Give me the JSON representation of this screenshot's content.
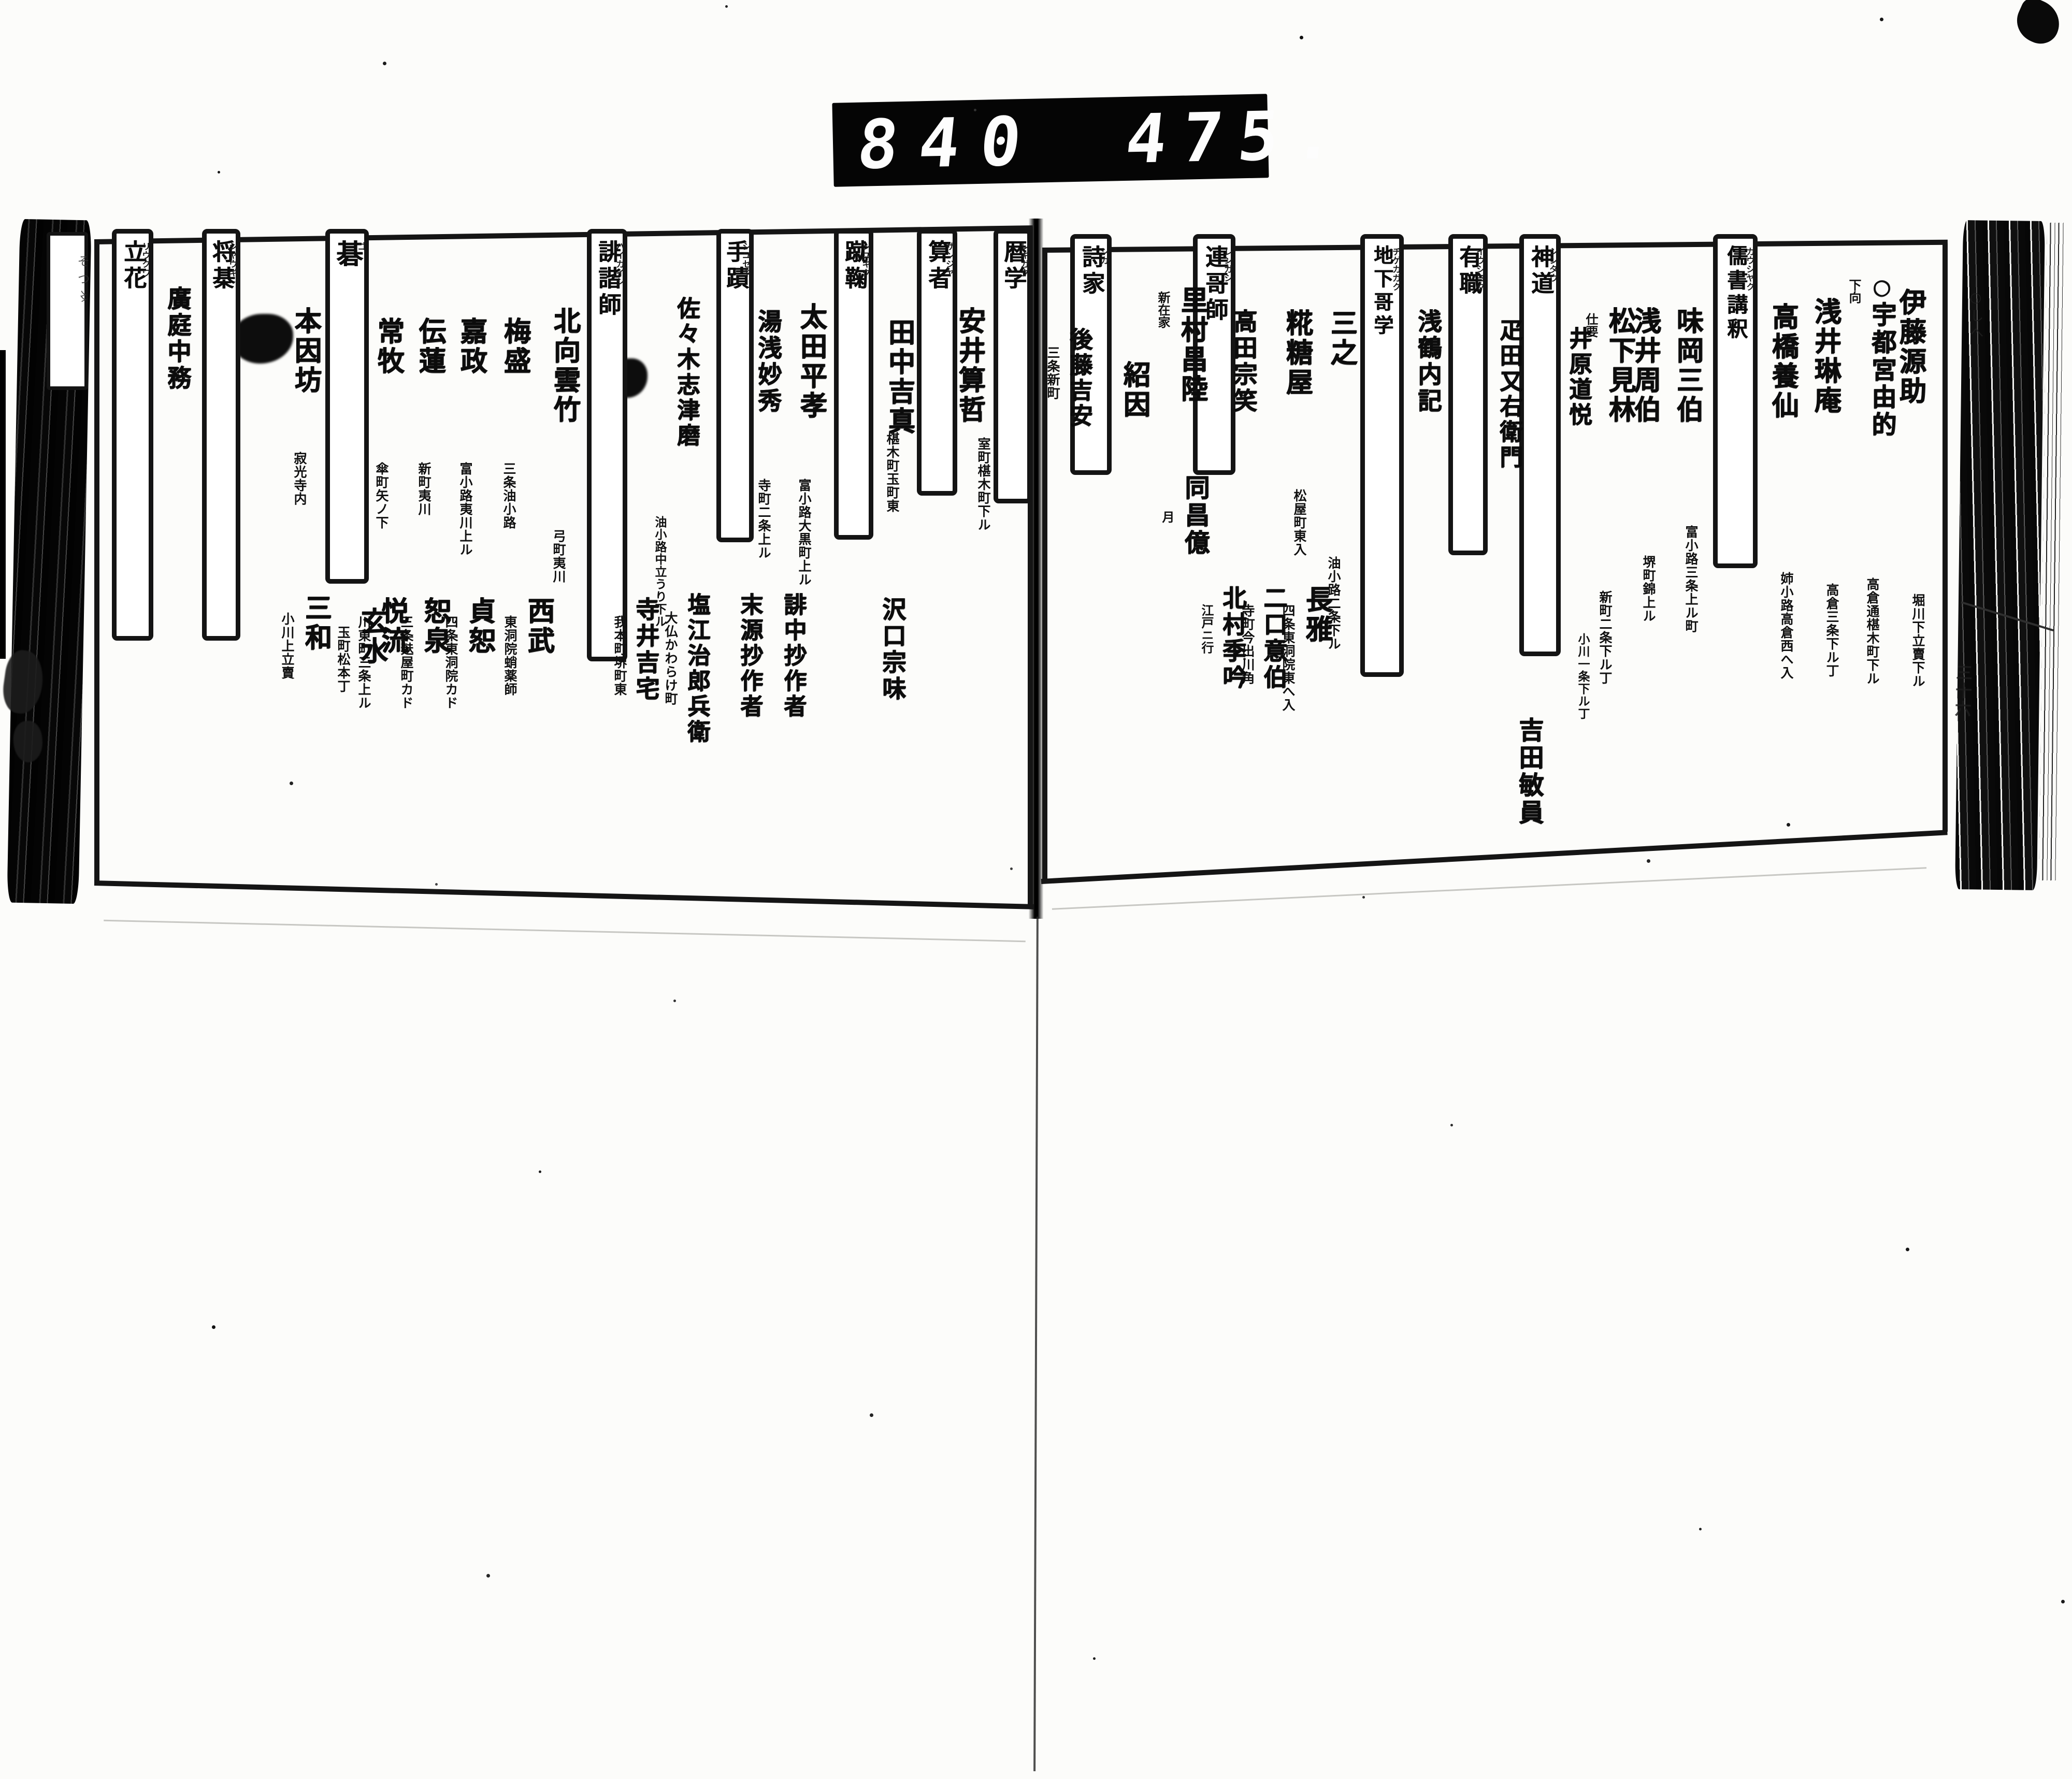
{
  "counter": {
    "left_digits": "840",
    "right_digits": "475."
  },
  "pages": {
    "right": {
      "tabs": [
        {
          "label": "儒書講釈",
          "furigana": "カウシヤク"
        },
        {
          "label": "神道",
          "furigana": "シンタウ"
        },
        {
          "label": "有職",
          "furigana": "イウシヨク"
        },
        {
          "label": "地下哥学",
          "furigana": "ヂゲカガク"
        },
        {
          "label": "連哥師",
          "furigana": "レンガシ"
        },
        {
          "label": "詩家",
          "furigana": "シカ"
        }
      ],
      "entries": [
        {
          "name": "伊藤源助",
          "addr": "堀川下立賣下ル"
        },
        {
          "mark": "○",
          "name": "宇都宮由的",
          "note": "下向",
          "addr": "高倉通椹木町下ル"
        },
        {
          "name": "浅井琳庵",
          "addr": "高倉三条下ル丁"
        },
        {
          "name": "高橋養仙",
          "addr": "姉小路高倉西へ入"
        },
        {
          "name": "味岡三伯",
          "addr": "富小路三条上ル町"
        },
        {
          "name": "浅井周伯",
          "addr": "堺町錦上ル"
        },
        {
          "name": "松下見林",
          "note": "仕要",
          "addr": "新町二条下ル丁"
        },
        {
          "name": "井原道悦",
          "addr": "小川一条下ル丁"
        },
        {
          "name": "疋田又右衛門"
        },
        {
          "name": "吉田敏員"
        },
        {
          "name": "浅鶴内記"
        },
        {
          "name": "三之",
          "addr": "油小路二条下ル"
        },
        {
          "name": "長雅",
          "addr": "四条東洞院東へ入"
        },
        {
          "name": "糀糖屋",
          "addr": "松屋町東入"
        },
        {
          "name": "二口意伯",
          "addr": "寺町今出川角"
        },
        {
          "name": "高田宗笑"
        },
        {
          "name": "北村季吟",
          "note": "江戸ニ行"
        },
        {
          "name": "里村昌陸",
          "note": "新在家"
        },
        {
          "name": "同昌億",
          "note": "月"
        },
        {
          "name": "紹因"
        },
        {
          "name": "後藤吉安",
          "addr": "三条新町"
        }
      ]
    },
    "left": {
      "tabs": [
        {
          "label": "暦学",
          "furigana": "レキガク"
        },
        {
          "label": "算者",
          "furigana": "サンジヤ"
        },
        {
          "label": "蹴鞠",
          "furigana": "シユキク"
        },
        {
          "label": "手蹟",
          "furigana": "シユセキ"
        },
        {
          "label": "誹諧師",
          "furigana": "ハイカイシ"
        },
        {
          "label": "碁",
          "furigana": "ゴ"
        },
        {
          "label": "将棊",
          "furigana": "シヤウギ"
        },
        {
          "label": "立花",
          "furigana": "リウクワ"
        }
      ],
      "entries": [
        {
          "name": "安井算哲",
          "addr": "室町椹木町下ル"
        },
        {
          "name": "田中吉真",
          "addr": "椹木町玉町東"
        },
        {
          "name": "沢口宗味"
        },
        {
          "name": "太田平孝",
          "addr": "富小路大黒町上ル"
        },
        {
          "name": "誹中抄作者"
        },
        {
          "name": "湯浅妙秀",
          "addr": "寺町二条上ル"
        },
        {
          "name": "末源抄作者"
        },
        {
          "name": "佐々木志津磨",
          "addr": "油小路中立うり下ル"
        },
        {
          "name": "塩江治郎兵衛",
          "addr": "大仏かわらけ町"
        },
        {
          "name": "寺井吉宅",
          "addr": "我本町堺町東"
        },
        {
          "name": "北向雲竹",
          "addr": "弓町夷川"
        },
        {
          "name": "梅盛",
          "addr": "三条油小路"
        },
        {
          "name": "西武",
          "addr": "東洞院蛸薬師"
        },
        {
          "name": "嘉政",
          "addr": "富小路夷川上ル"
        },
        {
          "name": "貞恕",
          "addr": "四条東洞院カド"
        },
        {
          "name": "伝蓮",
          "addr": "新町夷川"
        },
        {
          "name": "恕泉",
          "addr": "三条麸屋町カド"
        },
        {
          "name": "常牧",
          "addr": "傘町矢ノ下"
        },
        {
          "name": "悦流",
          "addr": "川東町三条上ル"
        },
        {
          "name": "本因坊",
          "addr": "寂光寺内"
        },
        {
          "name": "玄水",
          "addr": "玉町松本丁"
        },
        {
          "name": "三和",
          "addr": "小川上立賣"
        },
        {
          "name": "廣庭中務"
        }
      ]
    }
  },
  "margins": {
    "foredge_number": "三十六",
    "foredge_scribble": "○しへ",
    "left_scribble": "そつ〻"
  }
}
